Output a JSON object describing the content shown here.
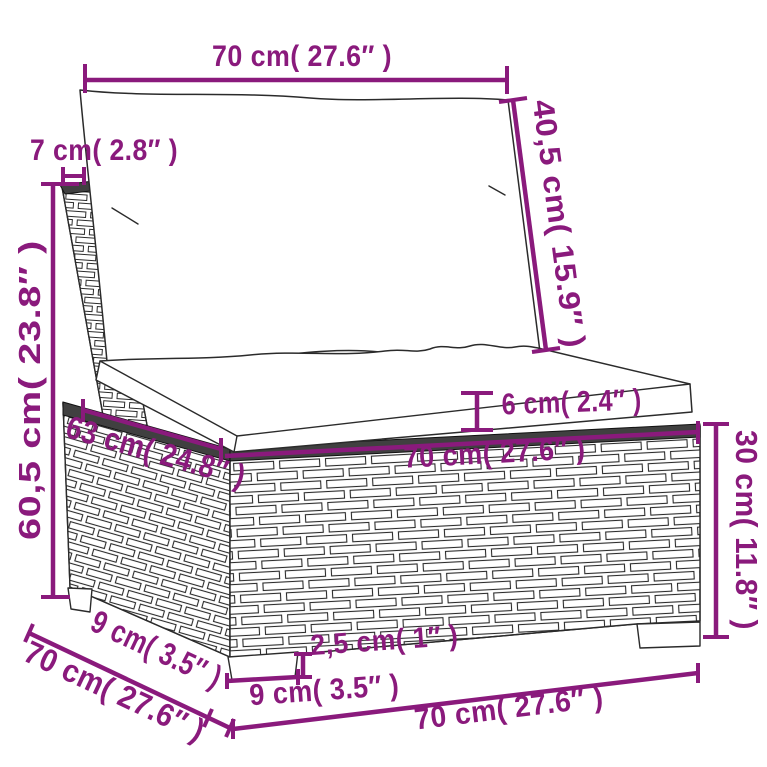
{
  "title": "Poly rattan sofa middle section with cushions — dimension diagram",
  "colors": {
    "dimension_accent": "#8a1a7c",
    "sketch_line": "#2b2b2b",
    "trim_band": "#404040",
    "background": "#ffffff"
  },
  "dimensions": {
    "back_width": "70 cm( 27.6″ )",
    "back_thickness": "7 cm( 2.8″ )",
    "back_cushion_height": "40,5 cm( 15.9″ )",
    "back_height": "60,5 cm( 23.8″ )",
    "seat_cushion_thickness": "6 cm( 2.4″ )",
    "seat_depth": "63 cm( 24.8″ )",
    "seat_width": "70 cm( 27.6″ )",
    "base_height": "30 cm( 11.8″ )",
    "foot_height": "2,5 cm( 1″ )",
    "foot_width": "9 cm( 3.5″ )",
    "foot_depth": "9 cm( 3.5″ )",
    "total_depth": "70 cm( 27.6″ )",
    "total_width": "70 cm( 27.6″ )"
  }
}
